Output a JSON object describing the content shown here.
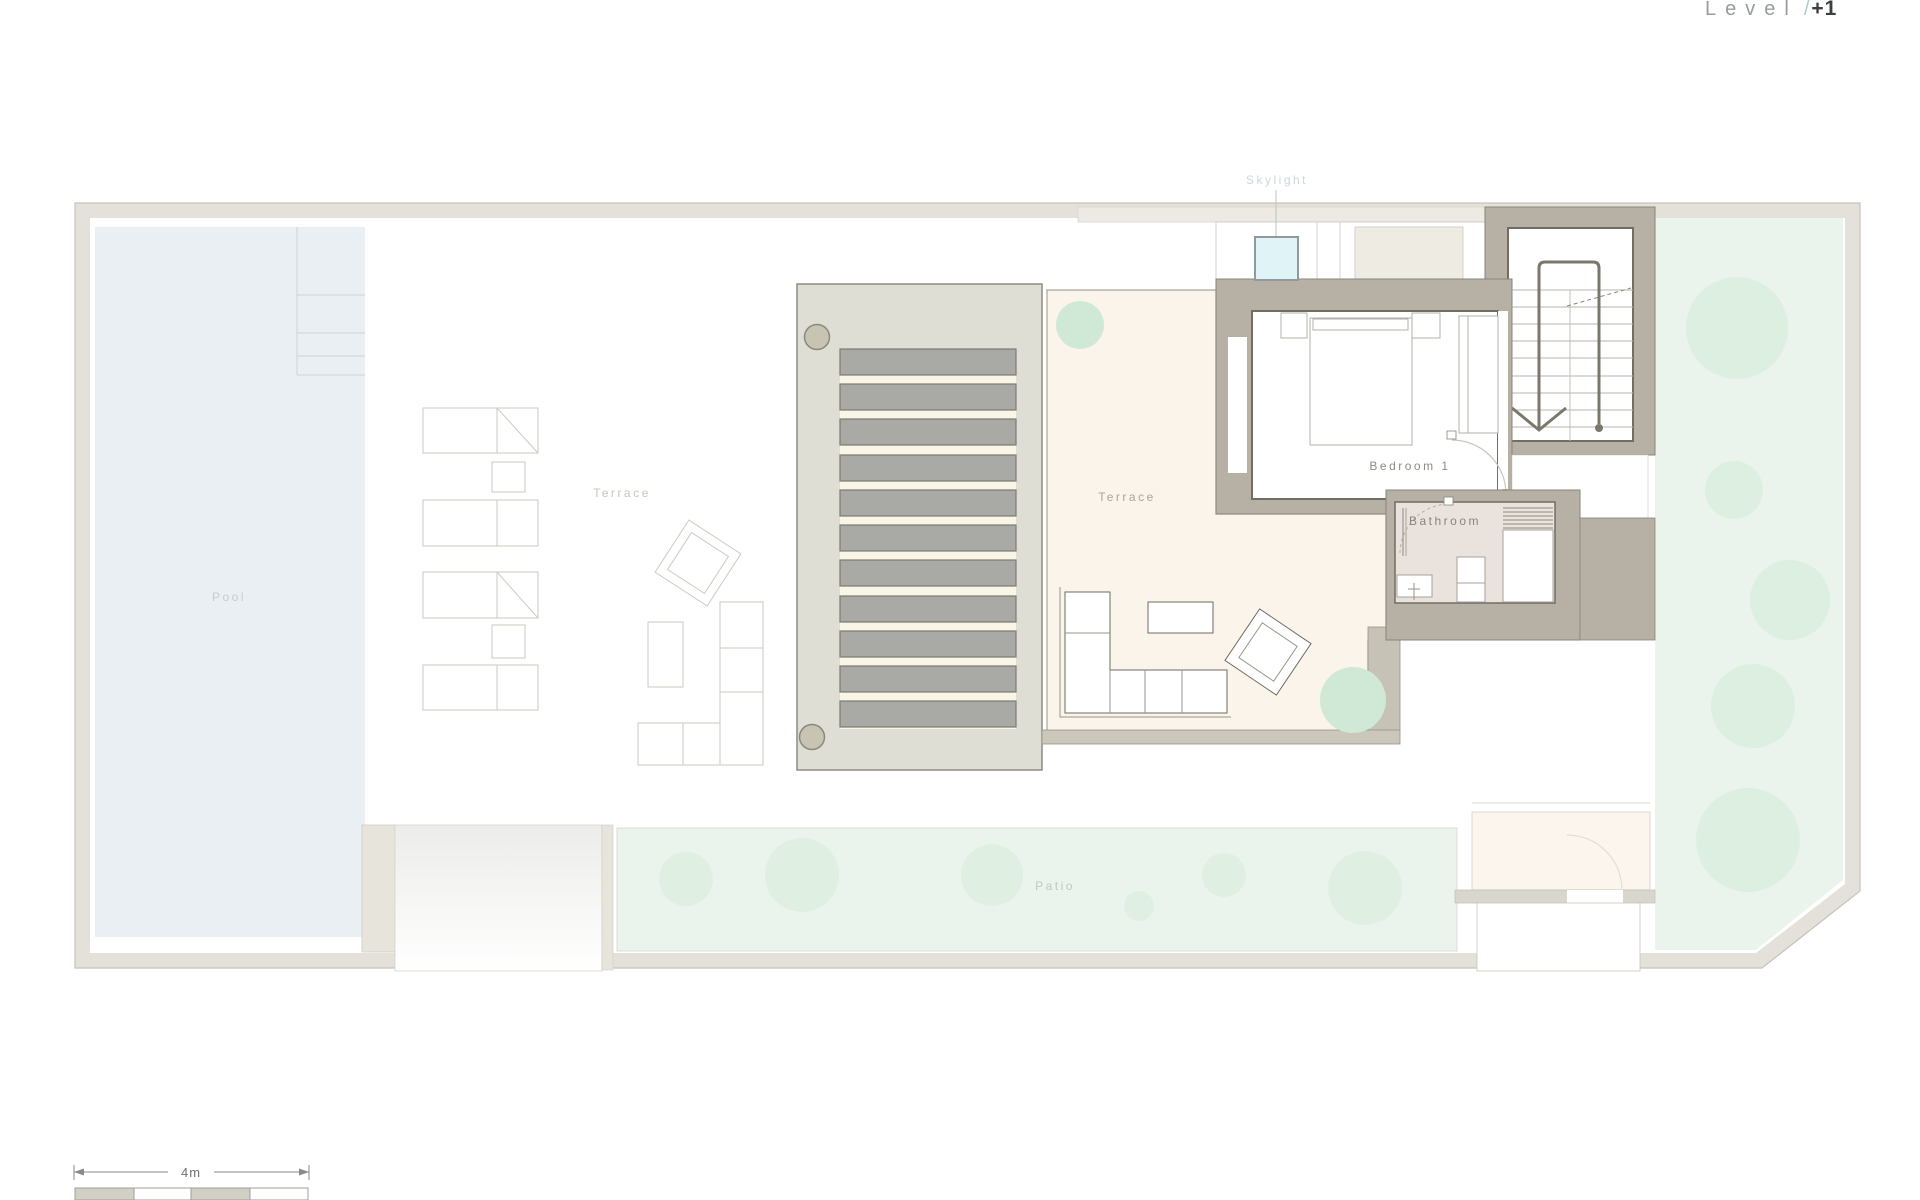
{
  "title": {
    "word": "Level",
    "separator": "/",
    "number": "+1"
  },
  "rooms": {
    "pool": "Pool",
    "terrace_west": "Terrace",
    "terrace_main": "Terrace",
    "bedroom": "Bedroom 1",
    "bathroom": "Bathroom",
    "skylight": "Skylight",
    "patio": "Patio"
  },
  "scale_bar": {
    "length_label": "4m",
    "segments": 4
  },
  "colors": {
    "site_band": "#e4e1da",
    "wall": "#b6b1a4",
    "wall_outline": "#8a8578",
    "pool_water": "#e9eff3",
    "terrace_cream": "#fbf4ea",
    "pergola_panel": "#dfded5",
    "pergola_slat": "#a9a9a5",
    "slat_gap": "#f9f5e7",
    "garden_green": "#ebf4ec",
    "tree_green": "#dcefe0",
    "bathroom_floor": "#eae2dc",
    "skylight_blue": "#e0f3f6",
    "title_accent": "#a9c9d1",
    "title_dark": "#3b3f41"
  }
}
